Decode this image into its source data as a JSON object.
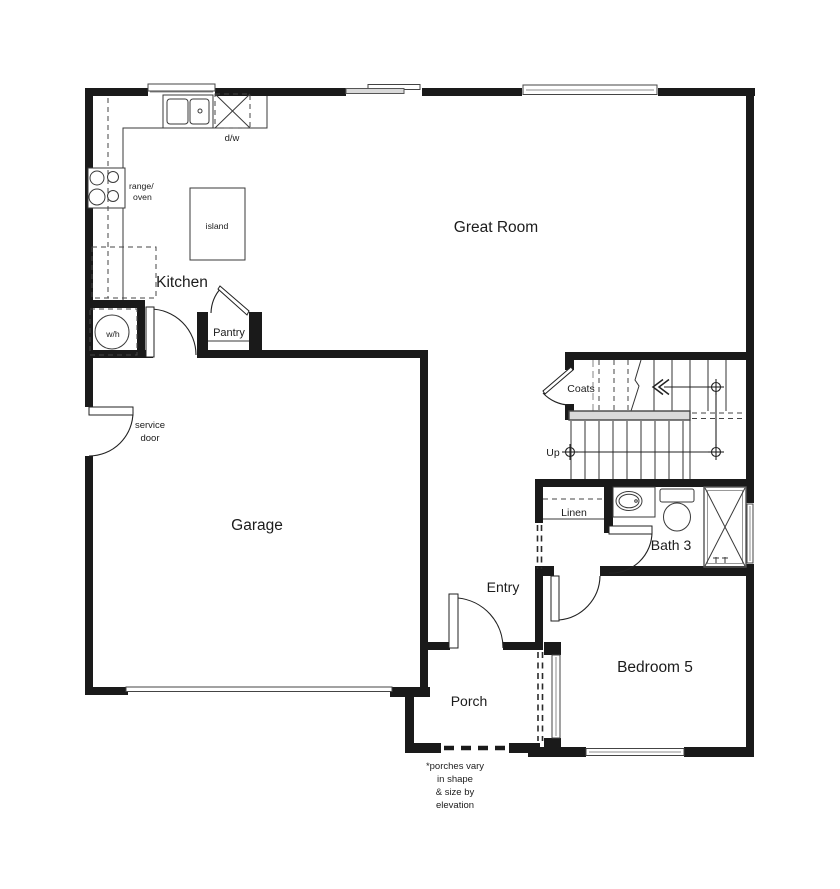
{
  "plan": {
    "rooms": {
      "great_room": "Great Room",
      "kitchen": "Kitchen",
      "garage": "Garage",
      "entry": "Entry",
      "porch": "Porch",
      "bedroom_5": "Bedroom 5",
      "bath_3": "Bath 3"
    },
    "fixtures": {
      "pantry": "Pantry",
      "coats": "Coats",
      "linen": "Linen",
      "water_heater": "w/h",
      "dishwasher": "d/w",
      "island": "island",
      "range_line_1": "range/",
      "range_line_2": "oven",
      "stairs_direction": "Up",
      "service_door_line_1": "service",
      "service_door_line_2": "door"
    },
    "footnote": {
      "line_1": "*porches vary",
      "line_2": "in shape",
      "line_3": "& size by",
      "line_4": "elevation"
    },
    "colors": {
      "wall": "#1a1a1a",
      "background": "#ffffff",
      "line": "#3a3a3a",
      "window_gray": "#8f8f8f",
      "rail_fill": "#d9d9d9"
    }
  }
}
